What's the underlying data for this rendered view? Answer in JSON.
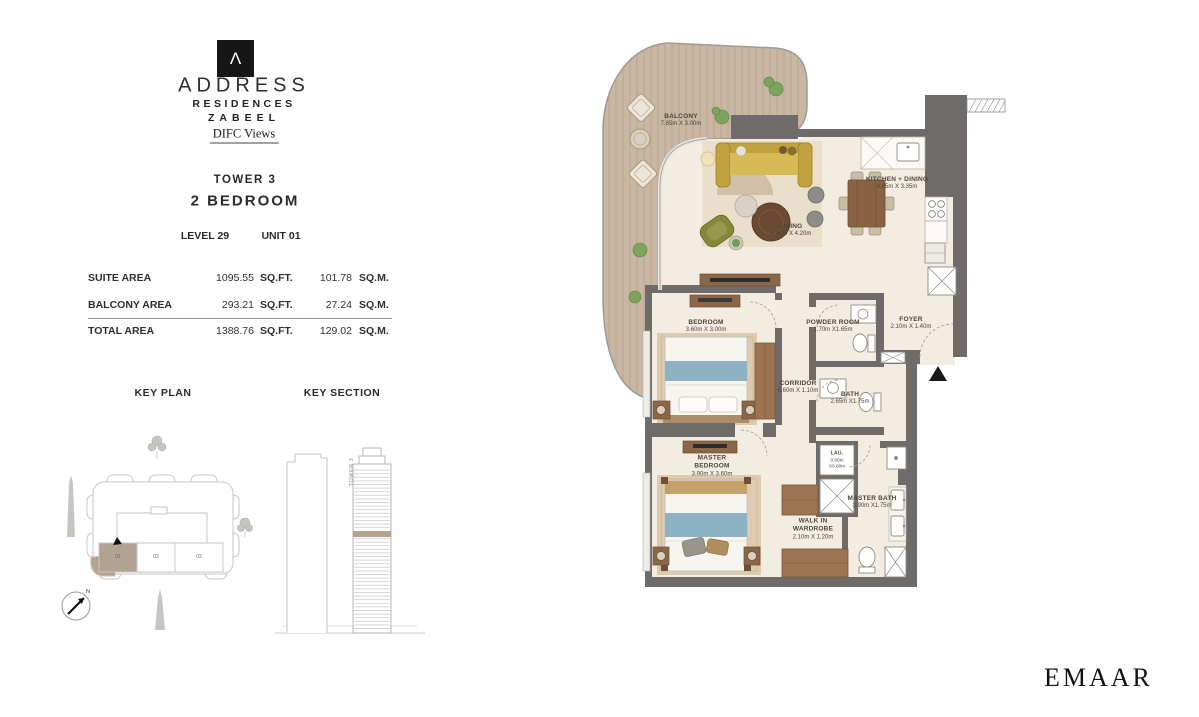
{
  "brand": {
    "logo_glyph": "Λ",
    "line1": "ADDRESS",
    "line2": "RESIDENCES",
    "line3": "ZABEEL",
    "views_label": "DIFC Views",
    "developer": "EMAAR"
  },
  "unit": {
    "tower": "TOWER 3",
    "type": "2 BEDROOM",
    "level": "LEVEL 29",
    "unit_no": "UNIT 01"
  },
  "areas": {
    "rows": [
      {
        "label": "SUITE AREA",
        "sqft": "1095.55",
        "sqft_unit": "SQ.FT.",
        "sqm": "101.78",
        "sqm_unit": "SQ.M."
      },
      {
        "label": "BALCONY AREA",
        "sqft": "293.21",
        "sqft_unit": "SQ.FT.",
        "sqm": "27.24",
        "sqm_unit": "SQ.M."
      },
      {
        "label": "TOTAL AREA",
        "sqft": "1388.76",
        "sqft_unit": "SQ.FT.",
        "sqm": "129.02",
        "sqm_unit": "SQ.M."
      }
    ]
  },
  "key_plan": {
    "title": "KEY PLAN",
    "units": {
      "u01": "01",
      "u03": "03",
      "u02": "02"
    }
  },
  "key_section": {
    "title": "KEY SECTION",
    "tower_label": "TOWER 3"
  },
  "compass": {
    "north": "N"
  },
  "plan": {
    "balcony": {
      "name": "BALCONY",
      "dims": "7.85m X 3.00m"
    },
    "living": {
      "name": "LIVING",
      "dims": "4.65m X 4.20m"
    },
    "kitchen": {
      "name": "KITCHEN + DINING",
      "dims": "4.65m X 3.35m"
    },
    "bedroom": {
      "name": "BEDROOM",
      "dims": "3.60m X 3.00m"
    },
    "powder": {
      "name": "POWDER ROOM",
      "dims": "1.70m X1.65m"
    },
    "foyer": {
      "name": "FOYER",
      "dims": "2.10m X 1.40m"
    },
    "corridor": {
      "name": "CORRIDOR",
      "dims": "5.60m X 1.10m"
    },
    "bath": {
      "name": "BATH",
      "dims": "2.65m X1.75m"
    },
    "master_bedroom": {
      "name": "MASTER BEDROOM",
      "dims": "3.90m X 3.60m"
    },
    "laundry": {
      "name": "LAU.",
      "dims_line1": "0.90m",
      "dims_line2": "X0.80m"
    },
    "master_bath": {
      "name": "MASTER BATH",
      "dims": "3.90m X1.75m"
    },
    "walk_in": {
      "name": "WALK IN WARDROBE",
      "dims": "2.10m X 1.20m"
    }
  },
  "colors": {
    "highlight": "#b2a291",
    "wall": "#6f6b6a",
    "deck": "#c9b7a3",
    "floor": "#f2ece1"
  }
}
